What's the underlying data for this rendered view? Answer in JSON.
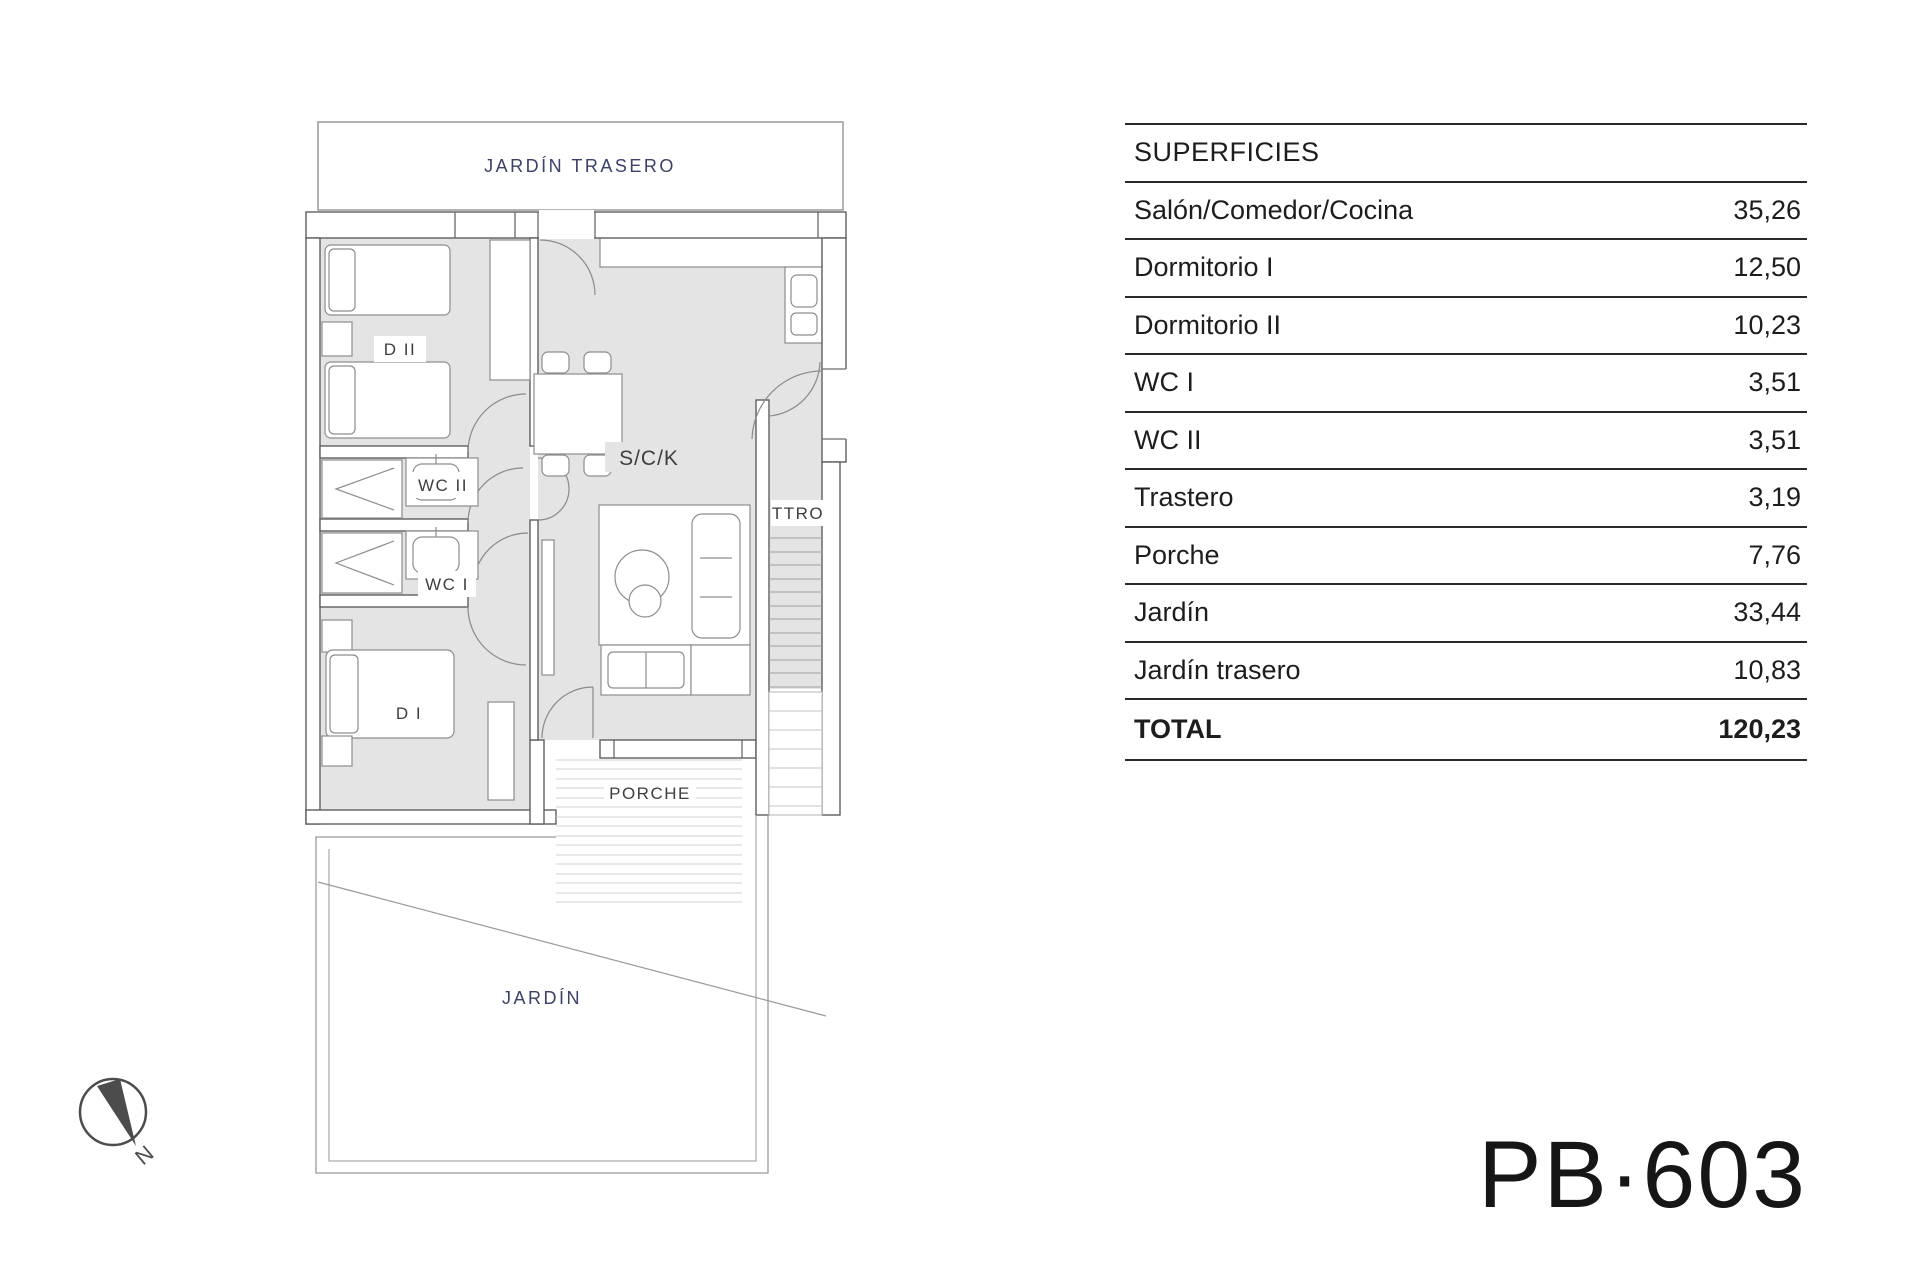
{
  "plan_code": "PB·603",
  "table": {
    "header": "SUPERFICIES",
    "rows": [
      {
        "label": "Salón/Comedor/Cocina",
        "value": "35,26"
      },
      {
        "label": "Dormitorio I",
        "value": "12,50"
      },
      {
        "label": "Dormitorio II",
        "value": "10,23"
      },
      {
        "label": "WC I",
        "value": "3,51"
      },
      {
        "label": "WC II",
        "value": "3,51"
      },
      {
        "label": "Trastero",
        "value": "3,19"
      },
      {
        "label": "Porche",
        "value": "7,76"
      },
      {
        "label": "Jardín",
        "value": "33,44"
      },
      {
        "label": "Jardín trasero",
        "value": "10,83"
      }
    ],
    "total": {
      "label": "TOTAL",
      "value": "120,23"
    }
  },
  "floor_plan": {
    "labels": {
      "jardin_trasero": "JARDÍN TRASERO",
      "dormitorio2": "D II",
      "wc2": "WC II",
      "wc1": "WC I",
      "dormitorio1": "D I",
      "salon_comedor_cocina": "S/C/K",
      "trastero": "TTRO",
      "porche": "PORCHE",
      "jardin": "JARDÍN",
      "north": "N"
    },
    "colors": {
      "room_fill": "#e4e4e4",
      "wall_line": "#5f5f5f",
      "furniture_stroke": "#8d8d8d",
      "garden_label": "#3b4169",
      "room_label": "#3e3e3e",
      "stair_line": "#9f9f9f",
      "hatch_line": "#d2d2d2"
    }
  }
}
